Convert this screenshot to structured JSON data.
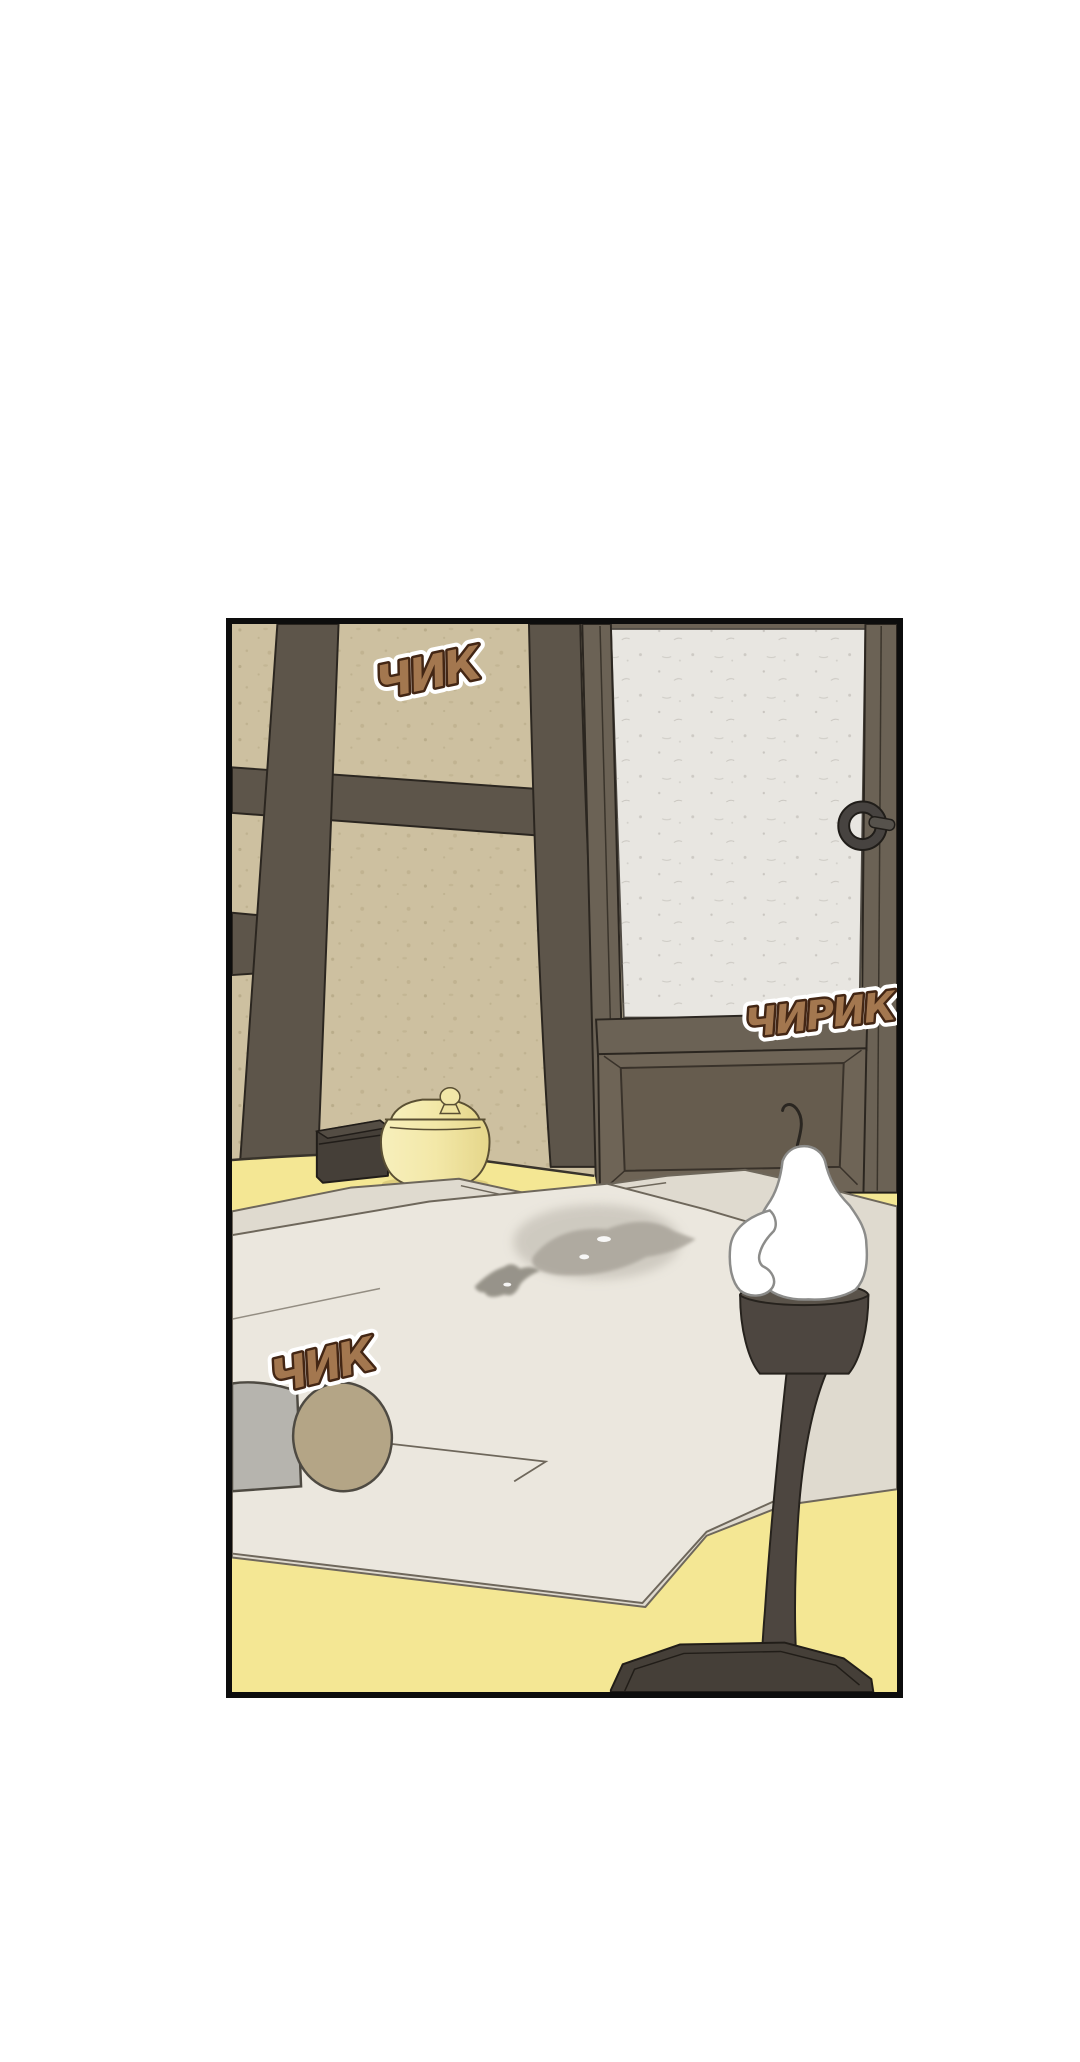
{
  "page": {
    "background_color": "#ffffff"
  },
  "panel": {
    "border_color": "#0d0d0d",
    "description": "Webtoon panel: empty traditional Korean room with beamed wall, paper sliding door with iron ring handle, lidded yellow jar and small wooden box by the wall, floor bedding with a damp stain, cylindrical pillow, and a white melted candle on a tall dark wooden candle stand."
  },
  "sfx": [
    {
      "text": "ЧИК",
      "placement": "upper wall, left of door"
    },
    {
      "text": "ЧИРИК",
      "placement": "over lower door panel"
    },
    {
      "text": "ЧИК",
      "placement": "above pillow on bedding"
    }
  ],
  "objects": [
    "hanok-wall-with-beams",
    "paper-sliding-door",
    "door-ring-handle",
    "wooden-storage-box",
    "yellow-lidded-jar",
    "floor-bedding",
    "bedding-stain",
    "cylindrical-pillow",
    "candle-stand-with-white-candle"
  ],
  "colors": {
    "wall_beige": "#cdc0a0",
    "wood_beam": "#5d554a",
    "door_wood": "#6b6255",
    "door_paper": "#e8e6e1",
    "floor_yellow": "#f4e794",
    "bedding_mat": "#dfdacf",
    "bedding_blanket": "#ebe7de",
    "stain_grey": "#aaa59b",
    "pillow_grey": "#b6b4ae",
    "pillow_cap_tan": "#b4a586",
    "jar_yellow": "#f3e8a8",
    "box_brown": "#453f38",
    "lamp_wood": "#4d4640",
    "candle_white": "#ffffff",
    "sfx_fill": "#a3774f",
    "sfx_outline": "#432614",
    "panel_border": "#0d0d0d"
  }
}
